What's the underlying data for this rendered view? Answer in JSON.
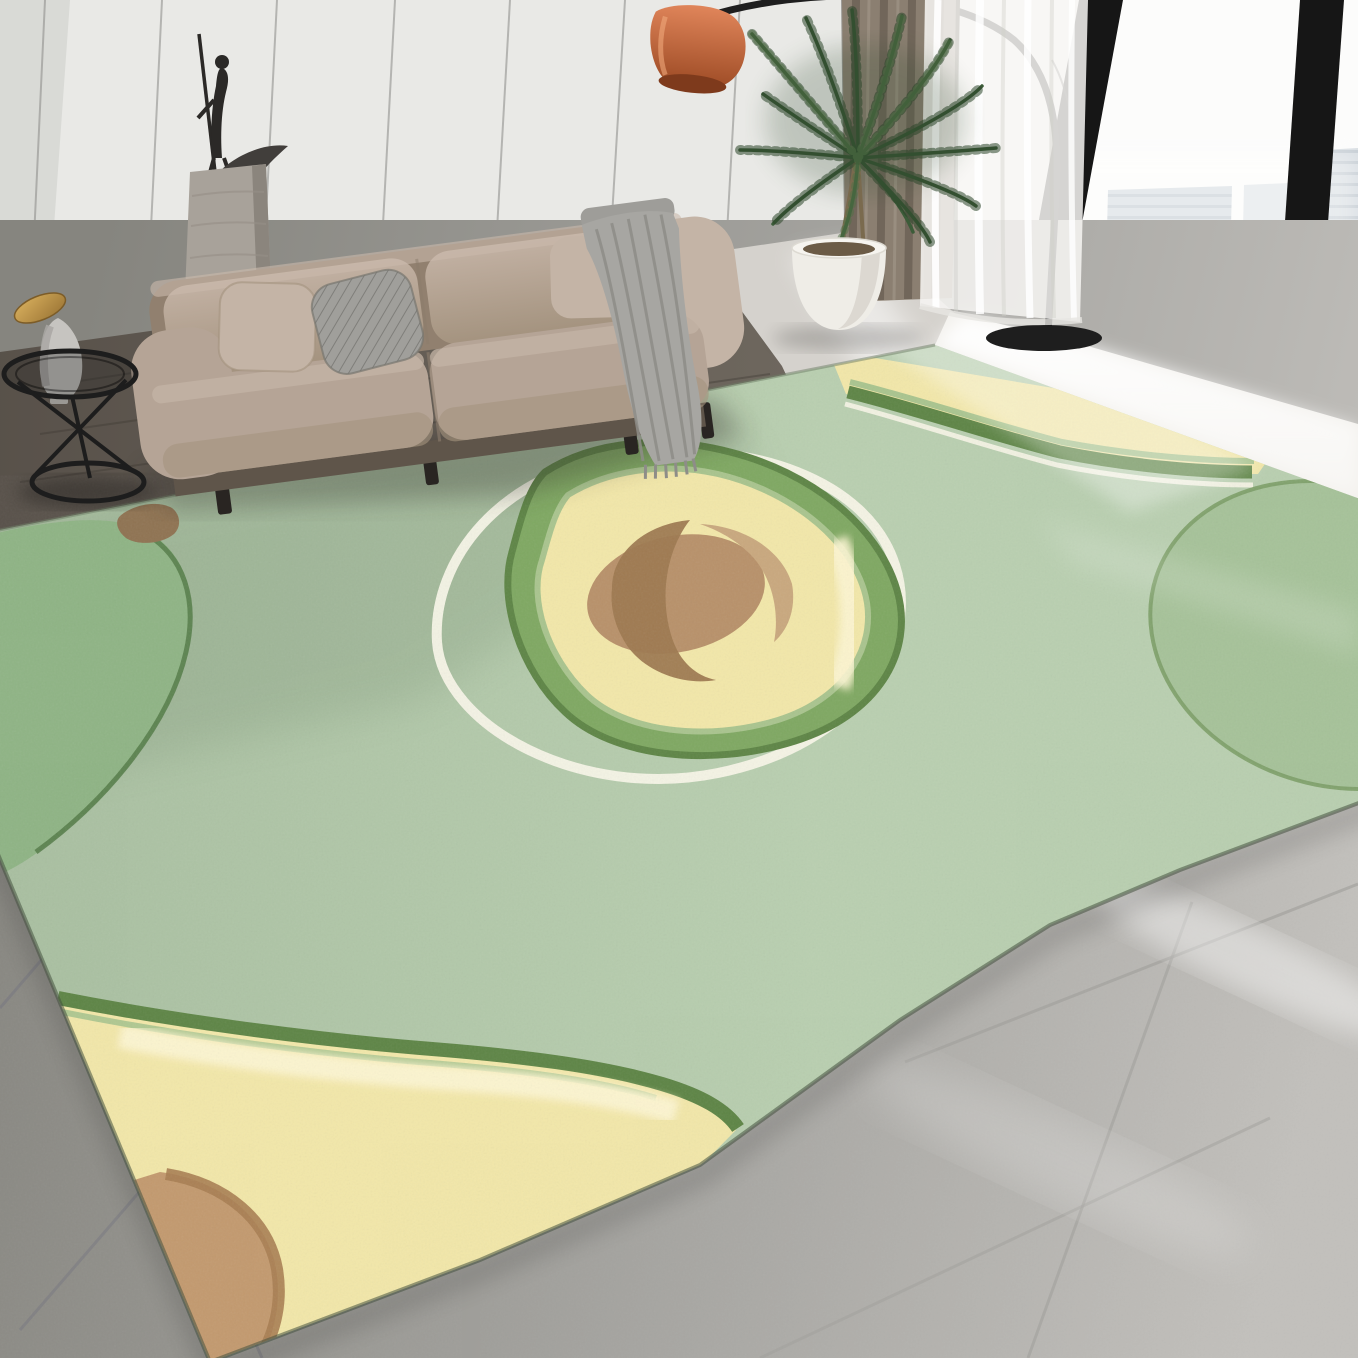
{
  "scene": {
    "description": "Product photo: avocado-print sage green area rug in a modern living room with beige sofa, arc floor lamp, palm plant, sheer and brown curtains, black-framed floor-to-ceiling windows with a hazy city skyline, white panelled wall and grey marble tile floor.",
    "objects": [
      {
        "name": "avocado-rug",
        "motifs": [
          "center avocado half with pit and white ring",
          "top-right avocado flesh slice",
          "right whole avocado",
          "left whole avocado with stem",
          "bottom-left avocado flesh with pit"
        ]
      },
      {
        "name": "sofa",
        "details": [
          "two taupe back cushions",
          "two seat cushions",
          "two taupe pillows",
          "grey patterned pillow",
          "grey throw blanket",
          "black legs"
        ]
      },
      {
        "name": "pedestal-sculpture",
        "details": [
          "stone pedestal",
          "black figure with staff",
          "dark crescent bowl"
        ]
      },
      {
        "name": "arc-floor-lamp",
        "details": [
          "terracotta shade",
          "black arc pole",
          "black round base"
        ]
      },
      {
        "name": "palm-plant",
        "details": [
          "white round pot",
          "dark green fronds"
        ]
      },
      {
        "name": "side-table",
        "details": [
          "black wire frame",
          "grey vase with brass cap"
        ]
      },
      {
        "name": "curtains",
        "details": [
          "brown drape",
          "white sheer"
        ]
      },
      {
        "name": "window-wall",
        "details": [
          "black mullions",
          "bright sky",
          "faint skyscrapers"
        ]
      },
      {
        "name": "floors",
        "details": [
          "dark wood strip near wall",
          "grey tiles bottom-left",
          "light marble with sunbeams bottom-right"
        ]
      }
    ]
  },
  "palette": {
    "wall": "#e9e9e6",
    "wallShade": "#d5d6d2",
    "seam": "#8a8a87",
    "baseboard": "#4b443c",
    "curtain": "#8b7f71",
    "curtainFold": "#6d6256",
    "curtainHi": "#9d9284",
    "sheer": "#f7f6f3",
    "frame": "#161616",
    "sky": "#fcfcfb",
    "building": "#ccd4da",
    "buildingStripe": "#b3bec6",
    "buildingFaint": "#dde3e7",
    "sillBright": "#f3f1ed",
    "beam": "#ffffff",
    "floorWoodA": "#554e47",
    "floorWoodB": "#6e675e",
    "floorLight": "#d5d2cd",
    "tileDark": "#8e8d8a",
    "tileGrout": "#767681",
    "marble": "#b5b3b0",
    "marbleVein": "#c9c7c3",
    "rugBg": "#b9cfb0",
    "rugShadow": "#51694d",
    "rindDark": "#5e8546",
    "rindMid": "#7fa862",
    "rindLight": "#a9c48e",
    "flesh": "#f2e7a9",
    "fleshHi": "#fcf5d2",
    "pit": "#b8916a",
    "pitDark": "#9d7950",
    "pitHi": "#c9a87e",
    "pitBottom": "#c39a6f",
    "pitBottomEdge": "#a87e52",
    "ring": "#f7f4e7",
    "avoRight": "#a6c299",
    "avoRightLine": "#7d9e68",
    "avoLeft": "#8fb485",
    "avoLeftLine": "#587e4b",
    "stemBrown": "#8f7352",
    "sofa": "#b5a496",
    "sofaLight": "#c4b4a6",
    "sofaDark": "#91806f",
    "sofaBase": "#5f554a",
    "sofaSeam": "#8d7d6d",
    "pillowGray": "#a09f9b",
    "pillowHatch": "#7f7e7a",
    "throw": "#a7a6a2",
    "throwFold": "#8e8d88",
    "leg": "#292522",
    "pedestal": "#a8a29a",
    "pedestalDark": "#8b857d",
    "sculpture": "#2b2927",
    "boat": "#413e3b",
    "shadeHi": "#e0855a",
    "shadeLo": "#9c4a24",
    "shadeInner": "#7e3a1c",
    "lampBlack": "#1e1e1e",
    "plant": "#3c5c39",
    "plantDark": "#2c462a",
    "plantLight": "#517146",
    "stemPlant": "#7a6a4e",
    "pot": "#efede7",
    "potShade": "#d8d4cc",
    "soil": "#6b5b46",
    "gold": "#d9b05e",
    "goldDark": "#9a7434",
    "decorGray": "#c6c4c0",
    "decorShade": "#a9a7a3",
    "tableBlack": "#1d1d1d"
  }
}
